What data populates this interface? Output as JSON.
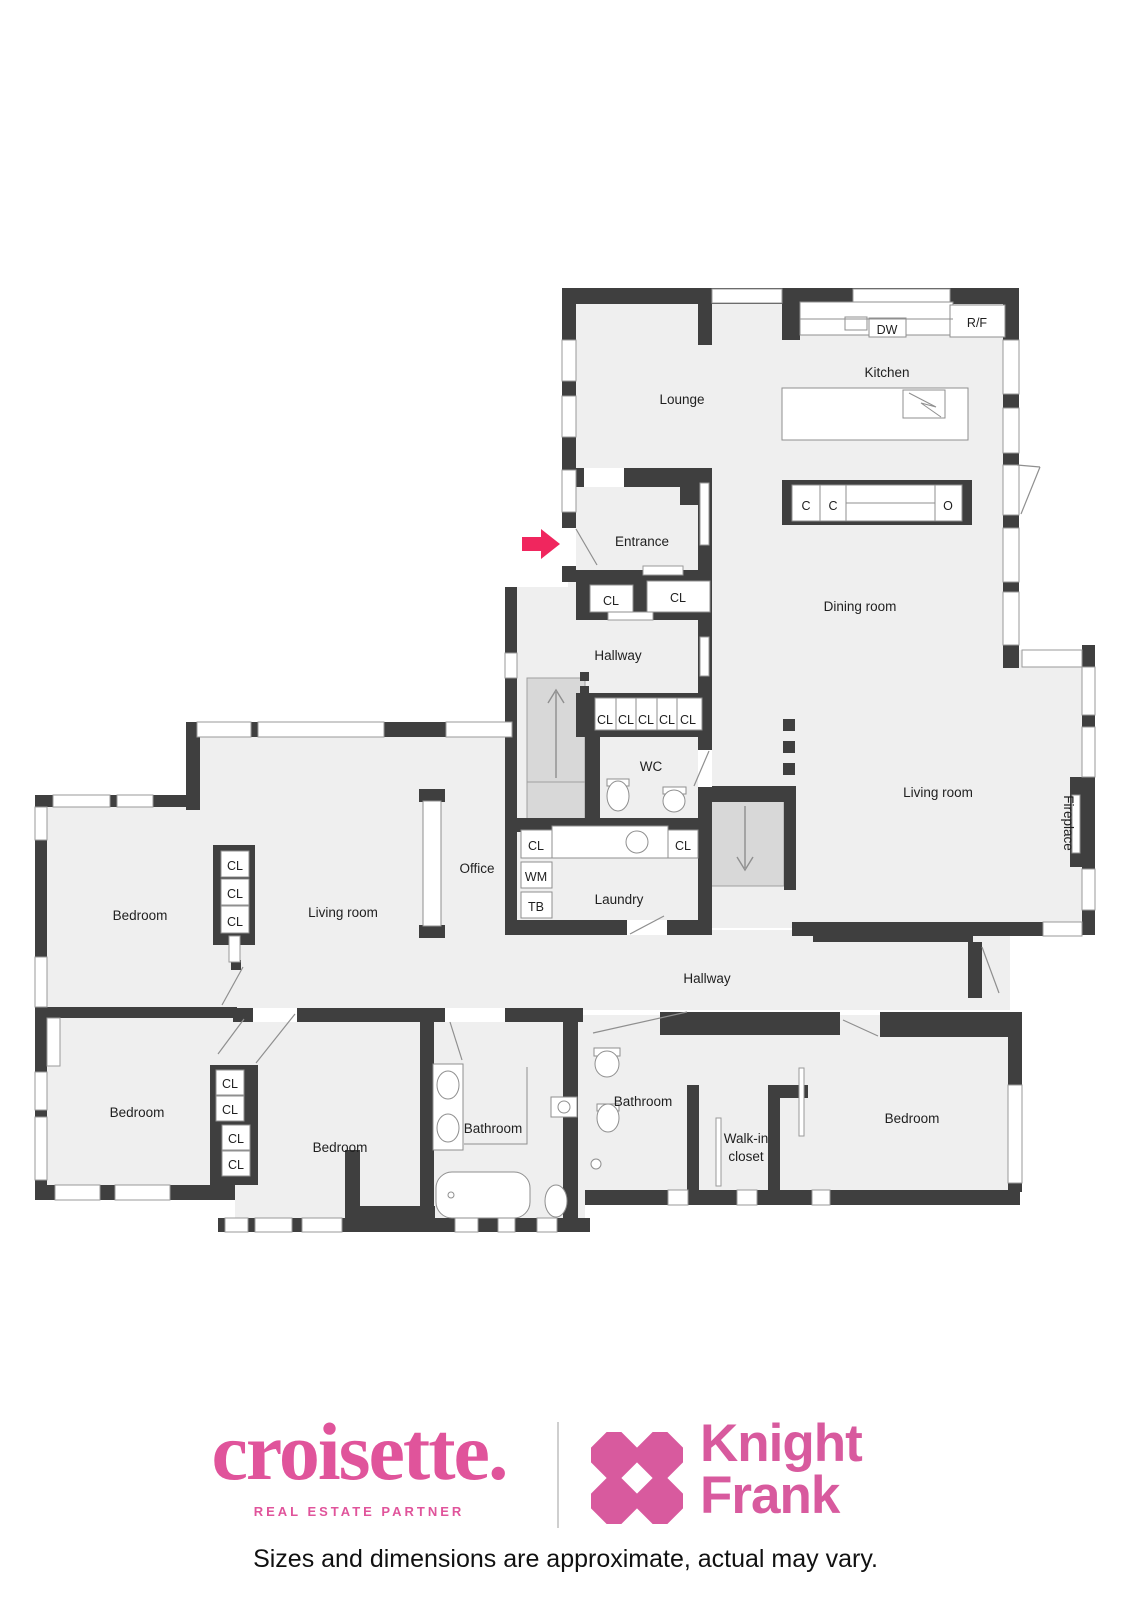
{
  "rooms": {
    "lounge": "Lounge",
    "kitchen": "Kitchen",
    "entrance": "Entrance",
    "dining_room": "Dining room",
    "hallway": "Hallway",
    "wc": "WC",
    "office": "Office",
    "laundry": "Laundry",
    "living_room": "Living room",
    "fireplace": "Fireplace",
    "bedroom": "Bedroom",
    "bathroom": "Bathroom",
    "walk_in_closet_line1": "Walk-in",
    "walk_in_closet_line2": "closet"
  },
  "fixtures": {
    "closet": "CL",
    "washing_machine": "WM",
    "tumble_dryer": "TB",
    "dishwasher": "DW",
    "fridge_freezer": "R/F",
    "cooker": "C",
    "oven": "O"
  },
  "branding": {
    "croisette_name": "croisette.",
    "croisette_tagline": "REAL ESTATE PARTNER",
    "knight_frank_line1": "Knight",
    "knight_frank_line2": "Frank"
  },
  "colors": {
    "croisette_pink": "#e0549b",
    "knight_frank_pink": "#d85a9e",
    "arrow_pink": "#f0265e",
    "wall": "#3f3f3f",
    "floor": "#efefef"
  },
  "disclaimer": "Sizes and dimensions are approximate, actual may vary."
}
